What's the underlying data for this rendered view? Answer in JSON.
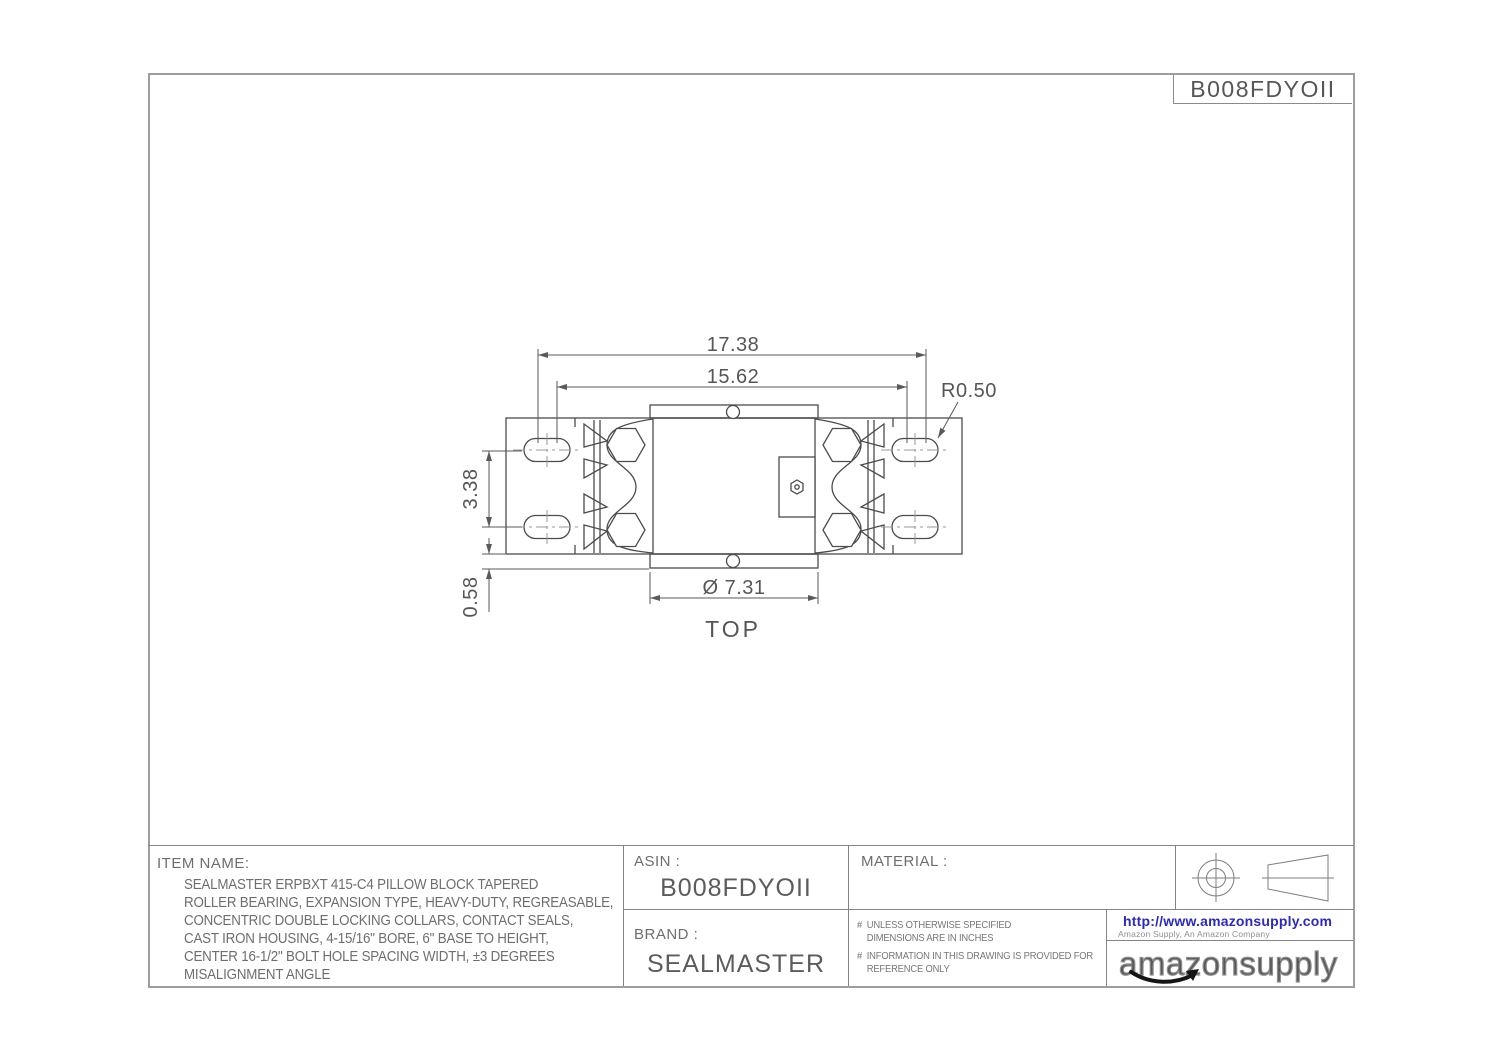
{
  "sheet": {
    "part_number": "B008FDYOII"
  },
  "drawing": {
    "view_label": "TOP",
    "dimensions": {
      "overall_width": "17.38",
      "bolt_slot_spacing": "15.62",
      "corner_radius": "R0.50",
      "slot_row_spacing": "3.38",
      "base_edge_offset": "0.58",
      "housing_diameter": "Ø 7.31"
    }
  },
  "title_block": {
    "item_name_label": "ITEM NAME:",
    "item_description": "SEALMASTER ERPBXT 415-C4 PILLOW BLOCK TAPERED\nROLLER BEARING, EXPANSION TYPE, HEAVY-DUTY, REGREASABLE,\nCONCENTRIC DOUBLE LOCKING COLLARS, CONTACT SEALS,\nCAST IRON HOUSING, 4-15/16\" BORE, 6\" BASE TO HEIGHT,\nCENTER 16-1/2\" BOLT HOLE SPACING WIDTH, ±3 DEGREES\nMISALIGNMENT ANGLE",
    "asin_label": "ASIN :",
    "asin_value": "B008FDYOII",
    "brand_label": "BRAND :",
    "brand_value": "SEALMASTER",
    "material_label": "MATERIAL :",
    "material_value": "",
    "notes": [
      {
        "bullet": "#",
        "text": "UNLESS OTHERWISE SPECIFIED\nDIMENSIONS ARE IN INCHES"
      },
      {
        "bullet": "#",
        "text": "INFORMATION IN THIS DRAWING IS PROVIDED FOR\nREFERENCE ONLY"
      }
    ],
    "website_url": "http://www.amazonsupply.com",
    "website_tagline": "Amazon Supply, An Amazon Company",
    "logo_text": "amazonsupply"
  },
  "colors": {
    "link_blue": "#2a2ac0",
    "smile_black": "#151515",
    "drawing_line": "#4c4c4c"
  }
}
